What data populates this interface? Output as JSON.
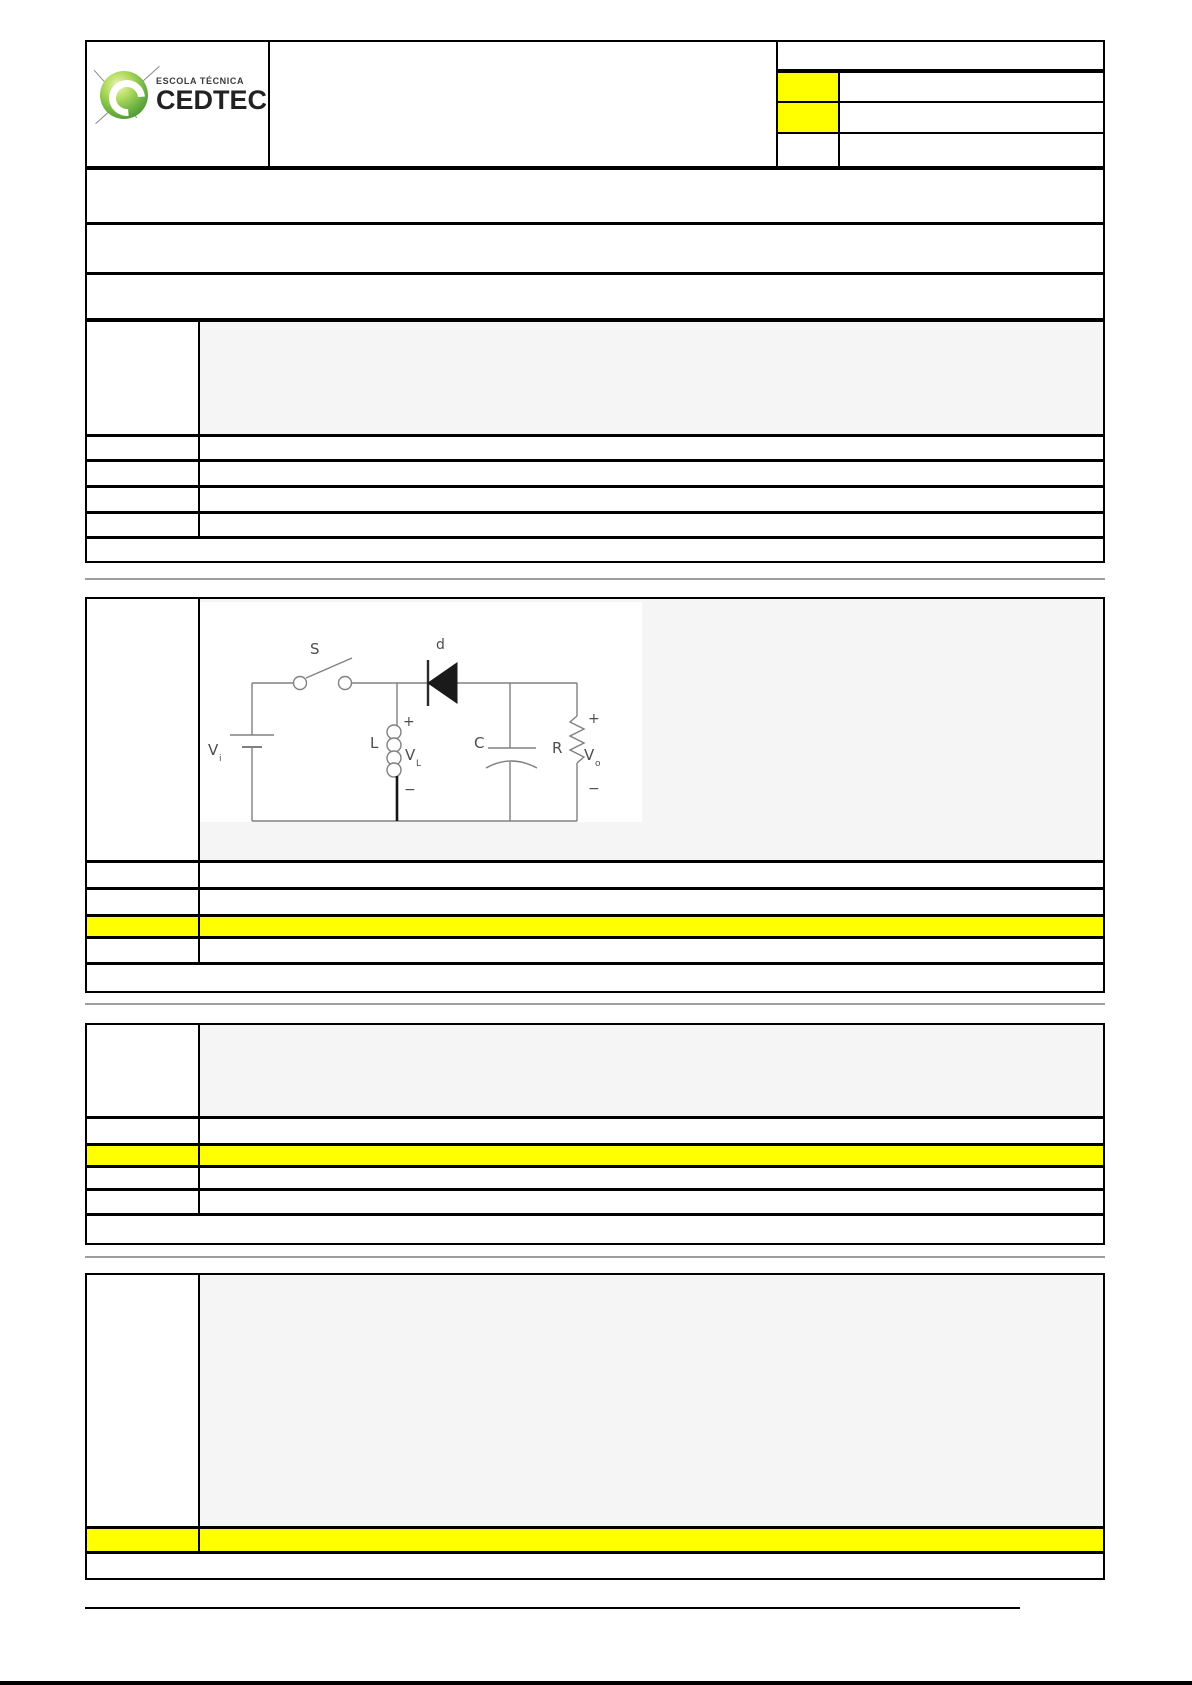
{
  "header": {
    "logo": {
      "line1": "ESCOLA TÉCNICA",
      "line2": "CEDTEC"
    }
  },
  "circuit": {
    "switch_label": "S",
    "diode_label": "d",
    "inductor_label": "L",
    "capacitor_label": "C",
    "resistor_label": "R",
    "source_label_main": "V",
    "source_label_sub": "i",
    "inductor_voltage_main": "V",
    "inductor_voltage_sub": "L",
    "output_voltage_main": "V",
    "output_voltage_sub": "o",
    "plus_sign": "+",
    "minus_sign": "−"
  },
  "colors": {
    "highlight_yellow": "#ffff00",
    "cell_gray": "#f5f5f5",
    "section_divider_gray": "#9e9e9e",
    "table_border_black": "#000000",
    "logo_green": "#6cb33f"
  }
}
